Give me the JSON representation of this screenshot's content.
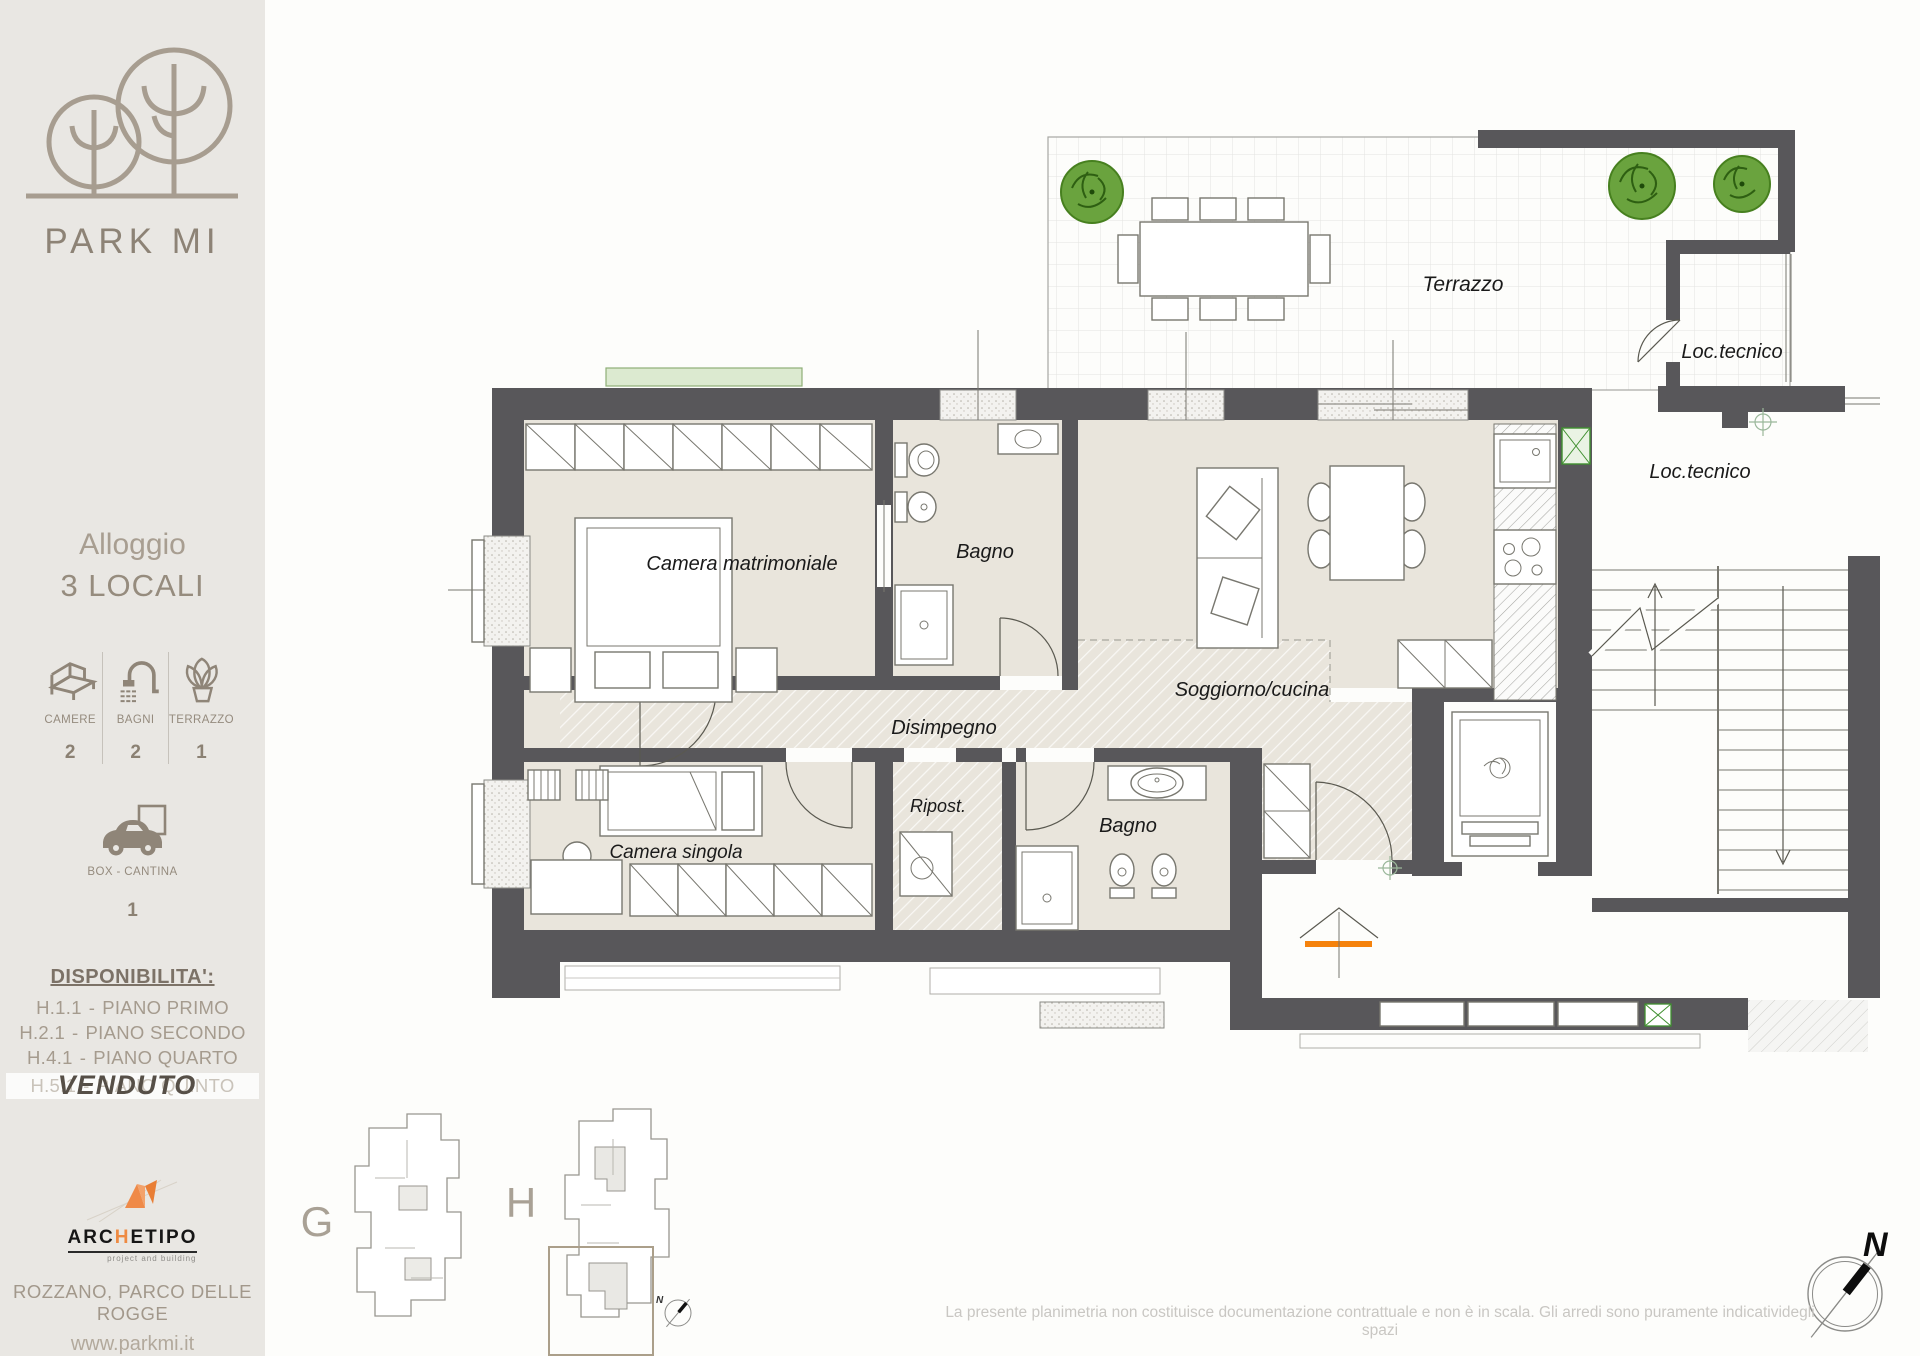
{
  "brand": {
    "name": "PARK MI"
  },
  "apartment": {
    "label": "Alloggio",
    "value": "3 LOCALI"
  },
  "stats": {
    "camere": {
      "icon": "bed-icon",
      "label": "CAMERE",
      "value": "2"
    },
    "bagni": {
      "icon": "shower-icon",
      "label": "BAGNI",
      "value": "2"
    },
    "terrazzo": {
      "icon": "plant-icon",
      "label": "TERRAZZO",
      "value": "1"
    },
    "box": {
      "icon": "car-icon",
      "label": "BOX - CANTINA",
      "value": "1"
    }
  },
  "availability": {
    "title": "DISPONIBILITA':",
    "separator": "-",
    "items": [
      {
        "code": "H.1.1",
        "floor": "PIANO PRIMO"
      },
      {
        "code": "H.2.1",
        "floor": "PIANO SECONDO"
      },
      {
        "code": "H.4.1",
        "floor": "PIANO QUARTO"
      },
      {
        "code": "H.5.1",
        "floor": "PIANO QUINTO",
        "status": "VENDUTO"
      }
    ]
  },
  "developer": {
    "name_pre": "ARC",
    "name_mid": "H",
    "name_post": "ETIPO",
    "tagline": "project and building"
  },
  "footer": {
    "location": "ROZZANO, PARCO DELLE ROGGE",
    "website": "www.parkmi.it"
  },
  "floorplan": {
    "labels": {
      "terrazzo": "Terrazzo",
      "loc_tecnico_top": "Loc.tecnico",
      "loc_tecnico_right": "Loc.tecnico",
      "camera_matrimoniale": "Camera matrimoniale",
      "bagno_top": "Bagno",
      "soggiorno": "Soggiorno/cucina",
      "disimpegno": "Disimpegno",
      "camera_singola": "Camera singola",
      "ripostiglio": "Ripost.",
      "bagno_bottom": "Bagno"
    }
  },
  "minimap": {
    "building_g": "G",
    "building_h": "H"
  },
  "compass": {
    "north": "N"
  },
  "disclaimer": "La presente planimetria non costituisce documentazione contrattuale e non è in scala. Gli arredi sono puramente indicatividegli spazi",
  "colors": {
    "sidebar_bg": "#e9e7e3",
    "wall": "#58575a",
    "floor": "#e9e5dc",
    "accent_orange": "#f5820c",
    "tree_green": "#6aa33e",
    "taupe": "#8d8376"
  }
}
